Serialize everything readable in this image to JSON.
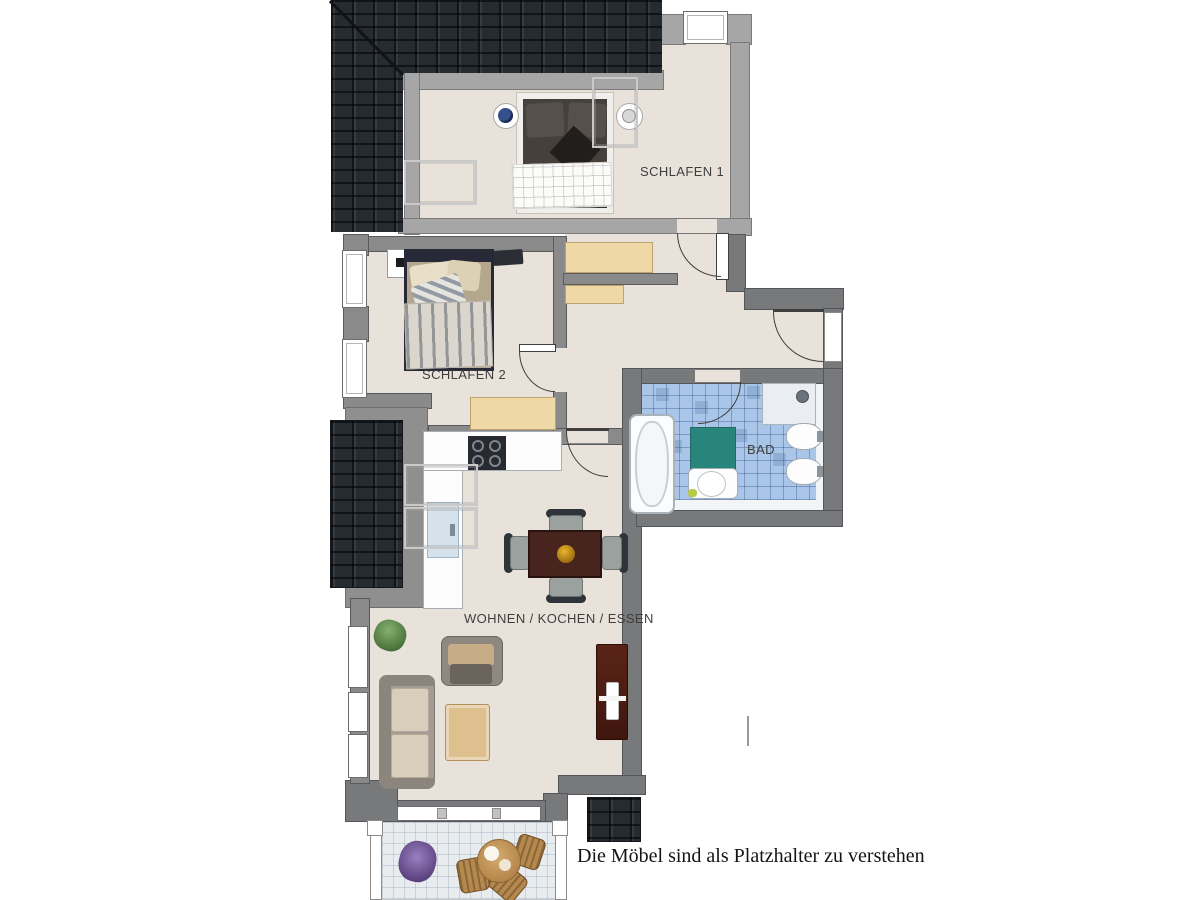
{
  "floorplan": {
    "note": "Die Möbel sind als Platzhalter zu verstehen",
    "rooms": [
      {
        "id": "schlafen1",
        "label": "SCHLAFEN 1"
      },
      {
        "id": "schlafen2",
        "label": "SCHLAFEN 2"
      },
      {
        "id": "bad",
        "label": "BAD"
      },
      {
        "id": "wohnen-kochen-essen",
        "label": "WOHNEN / KOCHEN / ESSEN"
      }
    ],
    "colors": {
      "floor": "#e9e2da",
      "wall": "#8a8a8a",
      "wall_light": "#a6a6a6",
      "wall_dark": "#77797b",
      "wall_edge": "#5a5a5a",
      "roof": "#262b31",
      "bath_tile": "#a9c5e7",
      "wood_light": "#eed9a6",
      "wood_dark": "#47241e",
      "mat_teal": "#27857c",
      "balcony_floor": "#e8ecef"
    }
  }
}
